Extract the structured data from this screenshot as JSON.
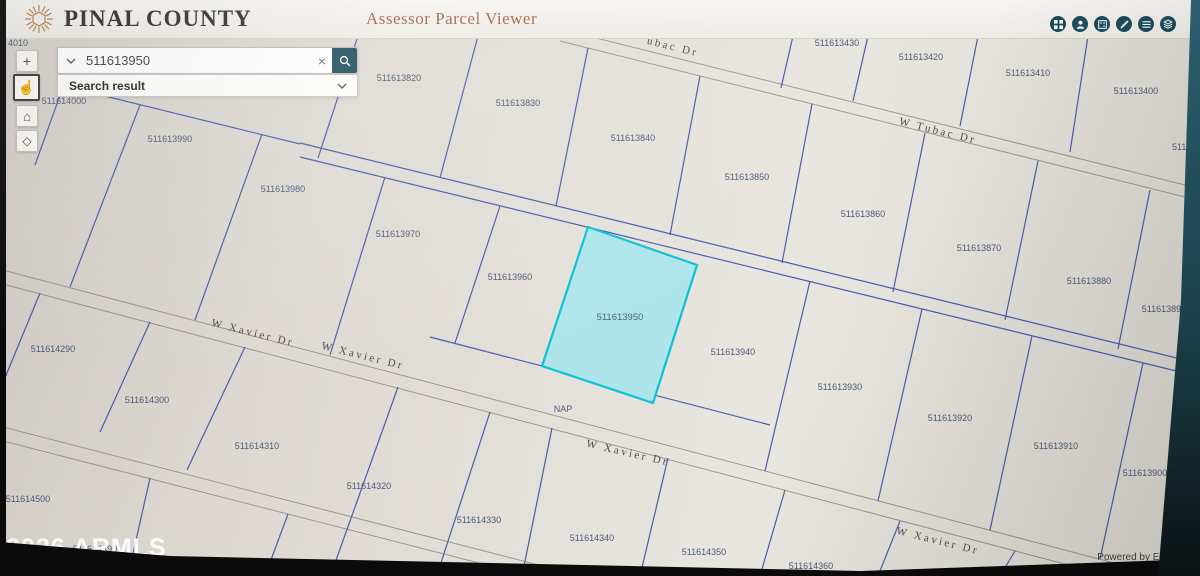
{
  "header": {
    "title": "PINAL COUNTY",
    "subtitle": "Assessor Parcel Viewer",
    "icons": [
      "apps-grid",
      "person",
      "basemap",
      "measure",
      "legend",
      "layers"
    ]
  },
  "toolbar": {
    "zoom_in": "+",
    "zoom_out_cursor": "☝",
    "home": "⌂",
    "locate": "◇"
  },
  "search": {
    "value": "511613950",
    "clear": "×",
    "result_label": "Search result"
  },
  "watermark": "2026 ARMLS",
  "attribution": "Powered by Esri",
  "colors": {
    "accent_teal": "#1d4d5e",
    "parcel_line": "#4a5cae",
    "road_line": "#9e988c",
    "map_label": "#4e5a7c",
    "highlight_fill": "#aee5eb",
    "highlight_stroke": "#0cc2d6"
  },
  "map": {
    "highlight": {
      "points": "588,227 697,265 653,403 542,366",
      "label": "511613950",
      "lx": 620,
      "ly": 320
    },
    "roads": [
      [
        560,
        29,
        1205,
        190
      ],
      [
        560,
        41,
        1205,
        202
      ],
      [
        -5,
        268,
        1205,
        587
      ],
      [
        -5,
        282,
        1205,
        601
      ],
      [
        -5,
        425,
        620,
        586
      ],
      [
        -5,
        439,
        600,
        594
      ]
    ],
    "parcel_lines": [
      [
        60,
        85,
        300,
        144
      ],
      [
        300,
        143,
        1205,
        365
      ],
      [
        300,
        157,
        1205,
        378
      ],
      [
        430,
        337,
        770,
        425
      ],
      [
        793,
        36,
        781,
        88
      ],
      [
        868,
        36,
        853,
        101
      ],
      [
        978,
        36,
        960,
        126
      ],
      [
        1088,
        36,
        1070,
        152
      ],
      [
        358,
        36,
        318,
        158
      ],
      [
        478,
        36,
        440,
        178
      ],
      [
        588,
        48,
        556,
        206
      ],
      [
        700,
        76,
        670,
        235
      ],
      [
        812,
        104,
        782,
        263
      ],
      [
        925,
        133,
        893,
        292
      ],
      [
        1038,
        161,
        1005,
        320
      ],
      [
        1150,
        190,
        1118,
        349
      ],
      [
        72,
        62,
        35,
        165
      ],
      [
        140,
        105,
        70,
        287
      ],
      [
        262,
        134,
        195,
        320
      ],
      [
        385,
        177,
        330,
        355
      ],
      [
        500,
        206,
        455,
        343
      ],
      [
        810,
        281,
        765,
        471
      ],
      [
        922,
        309,
        878,
        501
      ],
      [
        1032,
        336,
        990,
        530
      ],
      [
        1143,
        363,
        1100,
        559
      ],
      [
        40,
        293,
        2,
        385
      ],
      [
        150,
        322,
        100,
        432
      ],
      [
        245,
        347,
        187,
        470
      ],
      [
        398,
        387,
        335,
        563
      ],
      [
        490,
        412,
        438,
        572
      ],
      [
        552,
        428,
        522,
        576
      ],
      [
        668,
        458,
        640,
        576
      ],
      [
        785,
        490,
        760,
        576
      ],
      [
        900,
        521,
        878,
        576
      ],
      [
        1015,
        551,
        1000,
        576
      ],
      [
        150,
        478,
        128,
        576
      ],
      [
        288,
        514,
        265,
        576
      ]
    ],
    "parcel_labels": [
      {
        "t": "4010",
        "x": 8,
        "y": 46,
        "anchor": "start"
      },
      {
        "t": "511614000",
        "x": 64,
        "y": 104
      },
      {
        "t": "511613990",
        "x": 170,
        "y": 142
      },
      {
        "t": "511613980",
        "x": 283,
        "y": 192
      },
      {
        "t": "511613970",
        "x": 398,
        "y": 237
      },
      {
        "t": "511613960",
        "x": 510,
        "y": 280
      },
      {
        "t": "511613940",
        "x": 733,
        "y": 355
      },
      {
        "t": "511613930",
        "x": 840,
        "y": 390
      },
      {
        "t": "511613920",
        "x": 950,
        "y": 421
      },
      {
        "t": "511613910",
        "x": 1056,
        "y": 449
      },
      {
        "t": "511613900",
        "x": 1145,
        "y": 476
      },
      {
        "t": "511613820",
        "x": 399,
        "y": 81
      },
      {
        "t": "511613830",
        "x": 518,
        "y": 106
      },
      {
        "t": "511613840",
        "x": 633,
        "y": 141
      },
      {
        "t": "511613850",
        "x": 747,
        "y": 180
      },
      {
        "t": "511613860",
        "x": 863,
        "y": 217
      },
      {
        "t": "511613870",
        "x": 979,
        "y": 251
      },
      {
        "t": "511613880",
        "x": 1089,
        "y": 284
      },
      {
        "t": "511613890",
        "x": 1164,
        "y": 312
      },
      {
        "t": "511613430",
        "x": 837,
        "y": 46
      },
      {
        "t": "511613420",
        "x": 921,
        "y": 60
      },
      {
        "t": "511613410",
        "x": 1028,
        "y": 76
      },
      {
        "t": "511613400",
        "x": 1136,
        "y": 94
      },
      {
        "t": "51161",
        "x": 1172,
        "y": 150,
        "anchor": "start"
      },
      {
        "t": "511614290",
        "x": 53,
        "y": 352
      },
      {
        "t": "511614300",
        "x": 147,
        "y": 403
      },
      {
        "t": "511614310",
        "x": 257,
        "y": 449
      },
      {
        "t": "511614320",
        "x": 369,
        "y": 489
      },
      {
        "t": "511614330",
        "x": 479,
        "y": 523
      },
      {
        "t": "511614340",
        "x": 592,
        "y": 541
      },
      {
        "t": "511614350",
        "x": 704,
        "y": 555
      },
      {
        "t": "511614360",
        "x": 811,
        "y": 569
      },
      {
        "t": "511614500",
        "x": 28,
        "y": 502
      },
      {
        "t": "511614490",
        "x": 95,
        "y": 552
      },
      {
        "t": "511614480",
        "x": 207,
        "y": 573
      },
      {
        "t": "NAP",
        "x": 563,
        "y": 412
      }
    ],
    "street_labels": [
      {
        "t": "ubac Dr",
        "x": 672,
        "y": 50,
        "r": 14
      },
      {
        "t": "W Tubac Dr",
        "x": 937,
        "y": 134,
        "r": 14
      },
      {
        "t": "W Xavier Dr",
        "x": 252,
        "y": 336,
        "r": 14
      },
      {
        "t": "W Xavier Dr",
        "x": 362,
        "y": 359,
        "r": 14
      },
      {
        "t": "W Xavier Dr",
        "x": 627,
        "y": 456,
        "r": 13
      },
      {
        "t": "W Xavier Dr",
        "x": 937,
        "y": 544,
        "r": 14
      }
    ]
  }
}
